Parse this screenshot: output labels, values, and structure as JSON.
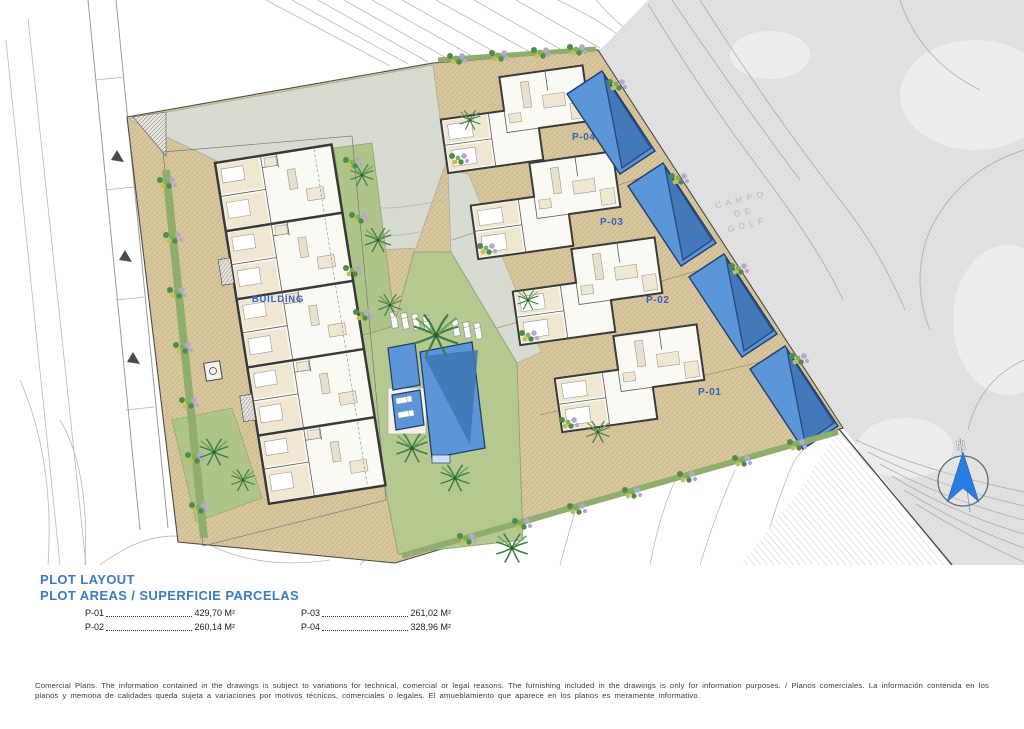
{
  "legend": {
    "title": "PLOT LAYOUT",
    "subtitle": "PLOT AREAS / SUPERFICIE PARCELAS"
  },
  "plots": [
    {
      "label": "P-01",
      "area": "429,70 M²"
    },
    {
      "label": "P-02",
      "area": "260,14 M²"
    },
    {
      "label": "P-03",
      "area": "261,02 M²"
    },
    {
      "label": "P-04",
      "area": "328,96 M²"
    }
  ],
  "plan": {
    "building_label": "BUILDING",
    "villa_labels": [
      "P-01",
      "P-02",
      "P-03",
      "P-04"
    ],
    "golf_label": [
      "CAMPO",
      "DE",
      "GOLF"
    ],
    "north_label": "N"
  },
  "colors": {
    "heading_blue": "#3b7bc1",
    "plan_label_blue": "#3560c0",
    "pool_blue": "#5c95d8",
    "pool_dark_blue": "#3a6db0",
    "terrace_tan": "#d9c79e",
    "lawn_green": "#b5c890",
    "hedge_green": "#8fae6d",
    "golf_gray": "#e2e2e2",
    "north_arrow_blue": "#2a7de0"
  },
  "disclaimer": "Comercial Plans. The information contained in the drawings is subject to variations for technical, comercial or legal reasons. The furnishing included in the drawings is only for information purposes. / Planos comerciales. La información contenida en los planos y memoria de calidades queda sujeta a variaciones por motivos técnicos, comerciales o legales. El amueblamiento que aparece en los planos es meramente informativo."
}
